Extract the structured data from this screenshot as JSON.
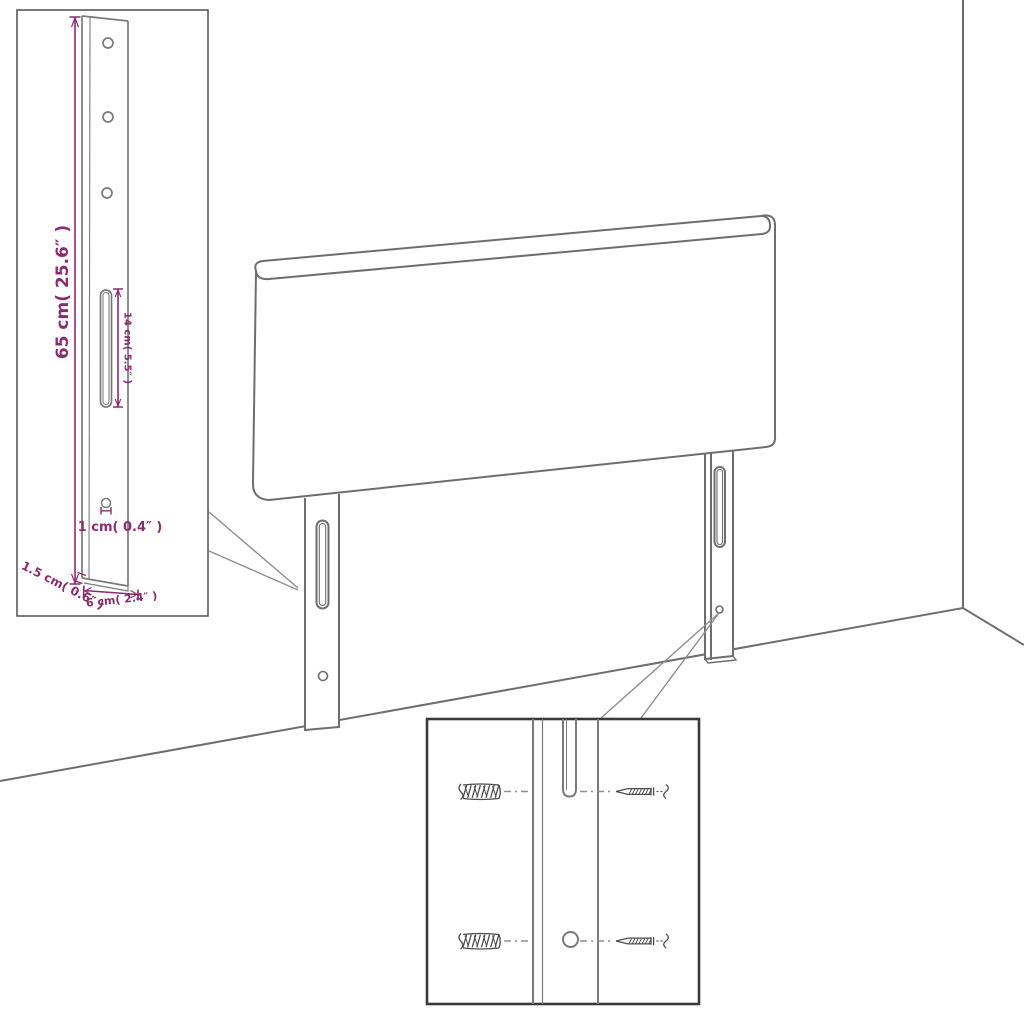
{
  "dimensions": {
    "leg_height": "65 cm( 25.6″ )",
    "slot_length": "14 cm( 5.5″ )",
    "hole_diameter": "1 cm( 0.4″ )",
    "leg_thickness": "1.5 cm( 0.6″ )",
    "leg_width": "6 cm( 2.4″ )"
  },
  "colors": {
    "dimension_accent": "#8B2C6E",
    "outline_gray": "#6E6E6E",
    "inset_border_dark": "#3A3A3A",
    "hardware_dark": "#4D4D4D",
    "background": "#FFFFFF"
  }
}
